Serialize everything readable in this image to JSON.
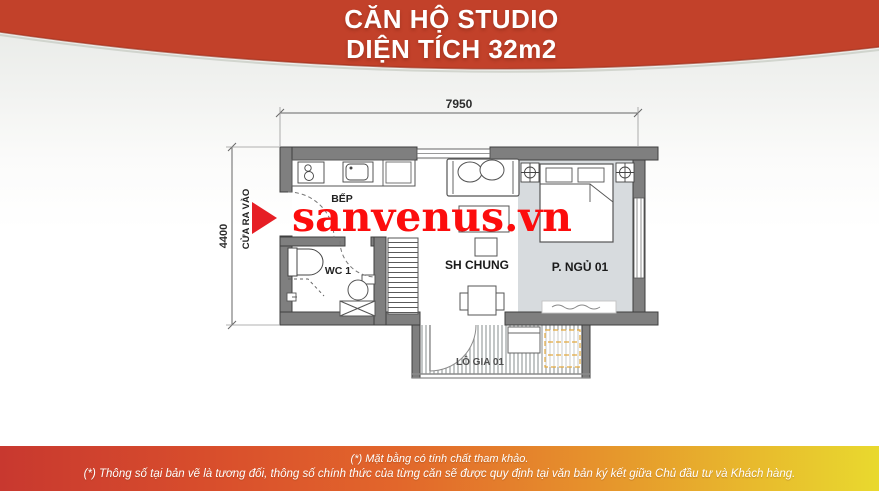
{
  "header": {
    "line1": "CĂN HỘ STUDIO",
    "line2": "DIỆN TÍCH 32m2"
  },
  "watermark": "sanvenus.vn",
  "plan": {
    "dim_width": "7950",
    "dim_height": "4400",
    "entrance_label": "CỬA RA VÀO",
    "rooms": {
      "kitchen": "BẾP",
      "wc": "WC 1",
      "living": "SH CHUNG",
      "bedroom": "P. NGỦ 01",
      "loggia": "LÔ GIA 01"
    }
  },
  "footer": {
    "line1": "(*) Mặt bằng có tính chất tham khảo.",
    "line2": "(*) Thông số tại bản vẽ là tương đối, thông số chính thức của từng căn sẽ được quy định tại văn bản ký kết giữa Chủ đầu tư và Khách hàng."
  },
  "colors": {
    "header_bg": "#c2412a",
    "footer_gradient_left": "#c8382f",
    "footer_gradient_mid": "#e2662b",
    "footer_gradient_right": "#e9d92e",
    "watermark_red": "#fc0d0d",
    "arrow_red": "#e61e25",
    "wall_gray": "#7f7f7f",
    "bedroom_floor": "#d7dbde",
    "loggia_accent": "#e3a93e"
  }
}
